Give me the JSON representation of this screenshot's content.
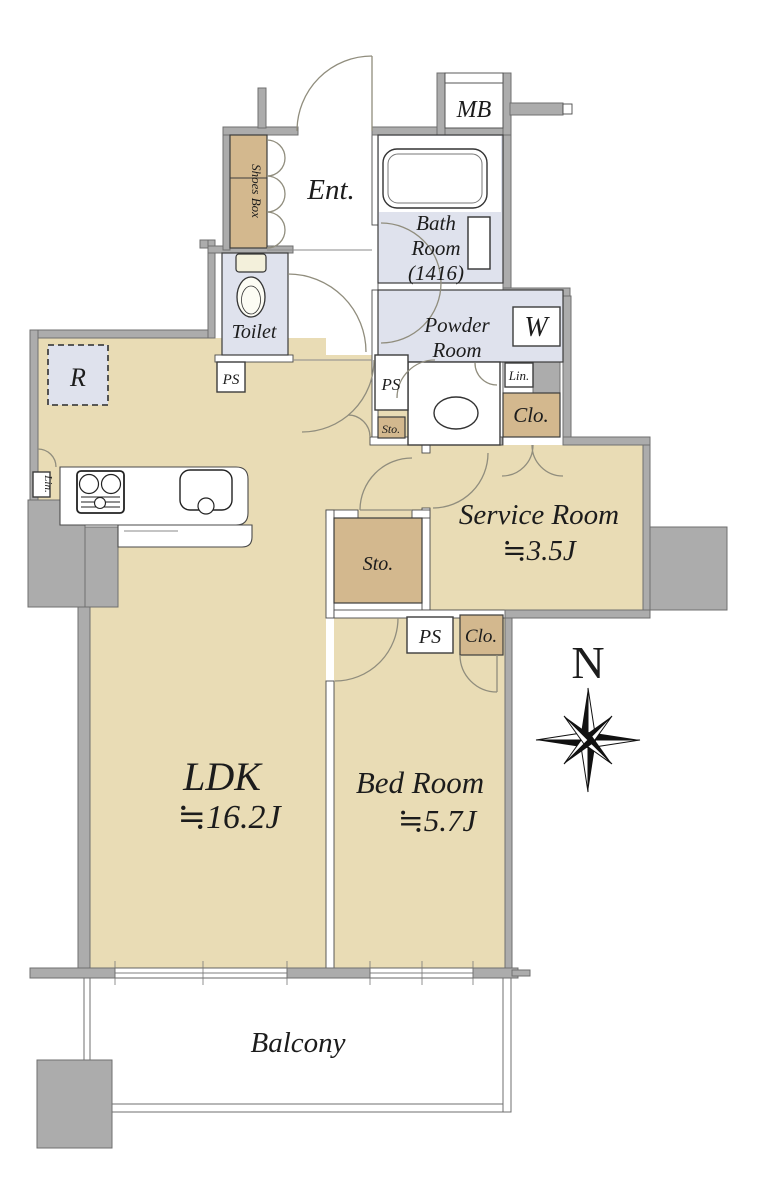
{
  "rooms": {
    "ldk": {
      "name": "LDK",
      "size": "≒16.2J"
    },
    "bedroom": {
      "name": "Bed Room",
      "size": "≒5.7J"
    },
    "service_room": {
      "name": "Service Room",
      "size": "≒3.5J"
    },
    "bath_room": {
      "line1": "Bath",
      "line2": "Room",
      "line3": "(1416)"
    },
    "powder_room": {
      "line1": "Powder",
      "line2": "Room"
    },
    "toilet": {
      "name": "Toilet"
    },
    "entrance": {
      "name": "Ent."
    },
    "balcony": {
      "name": "Balcony"
    }
  },
  "labels": {
    "meter_box": "MB",
    "washer": "W",
    "refrigerator": "R",
    "shoes_box": "Shoes Box",
    "pipe_space": "PS",
    "storage": "Sto.",
    "closet": "Clo.",
    "linen": "Lin.",
    "north": "N"
  },
  "colors": {
    "floor_tan": "#e9dcb5",
    "floor_tan_dark": "#d3b88e",
    "wet_area_blue": "#dfe2ed",
    "wall_gray": "#acacac",
    "line_dark": "#3c3c3c"
  }
}
